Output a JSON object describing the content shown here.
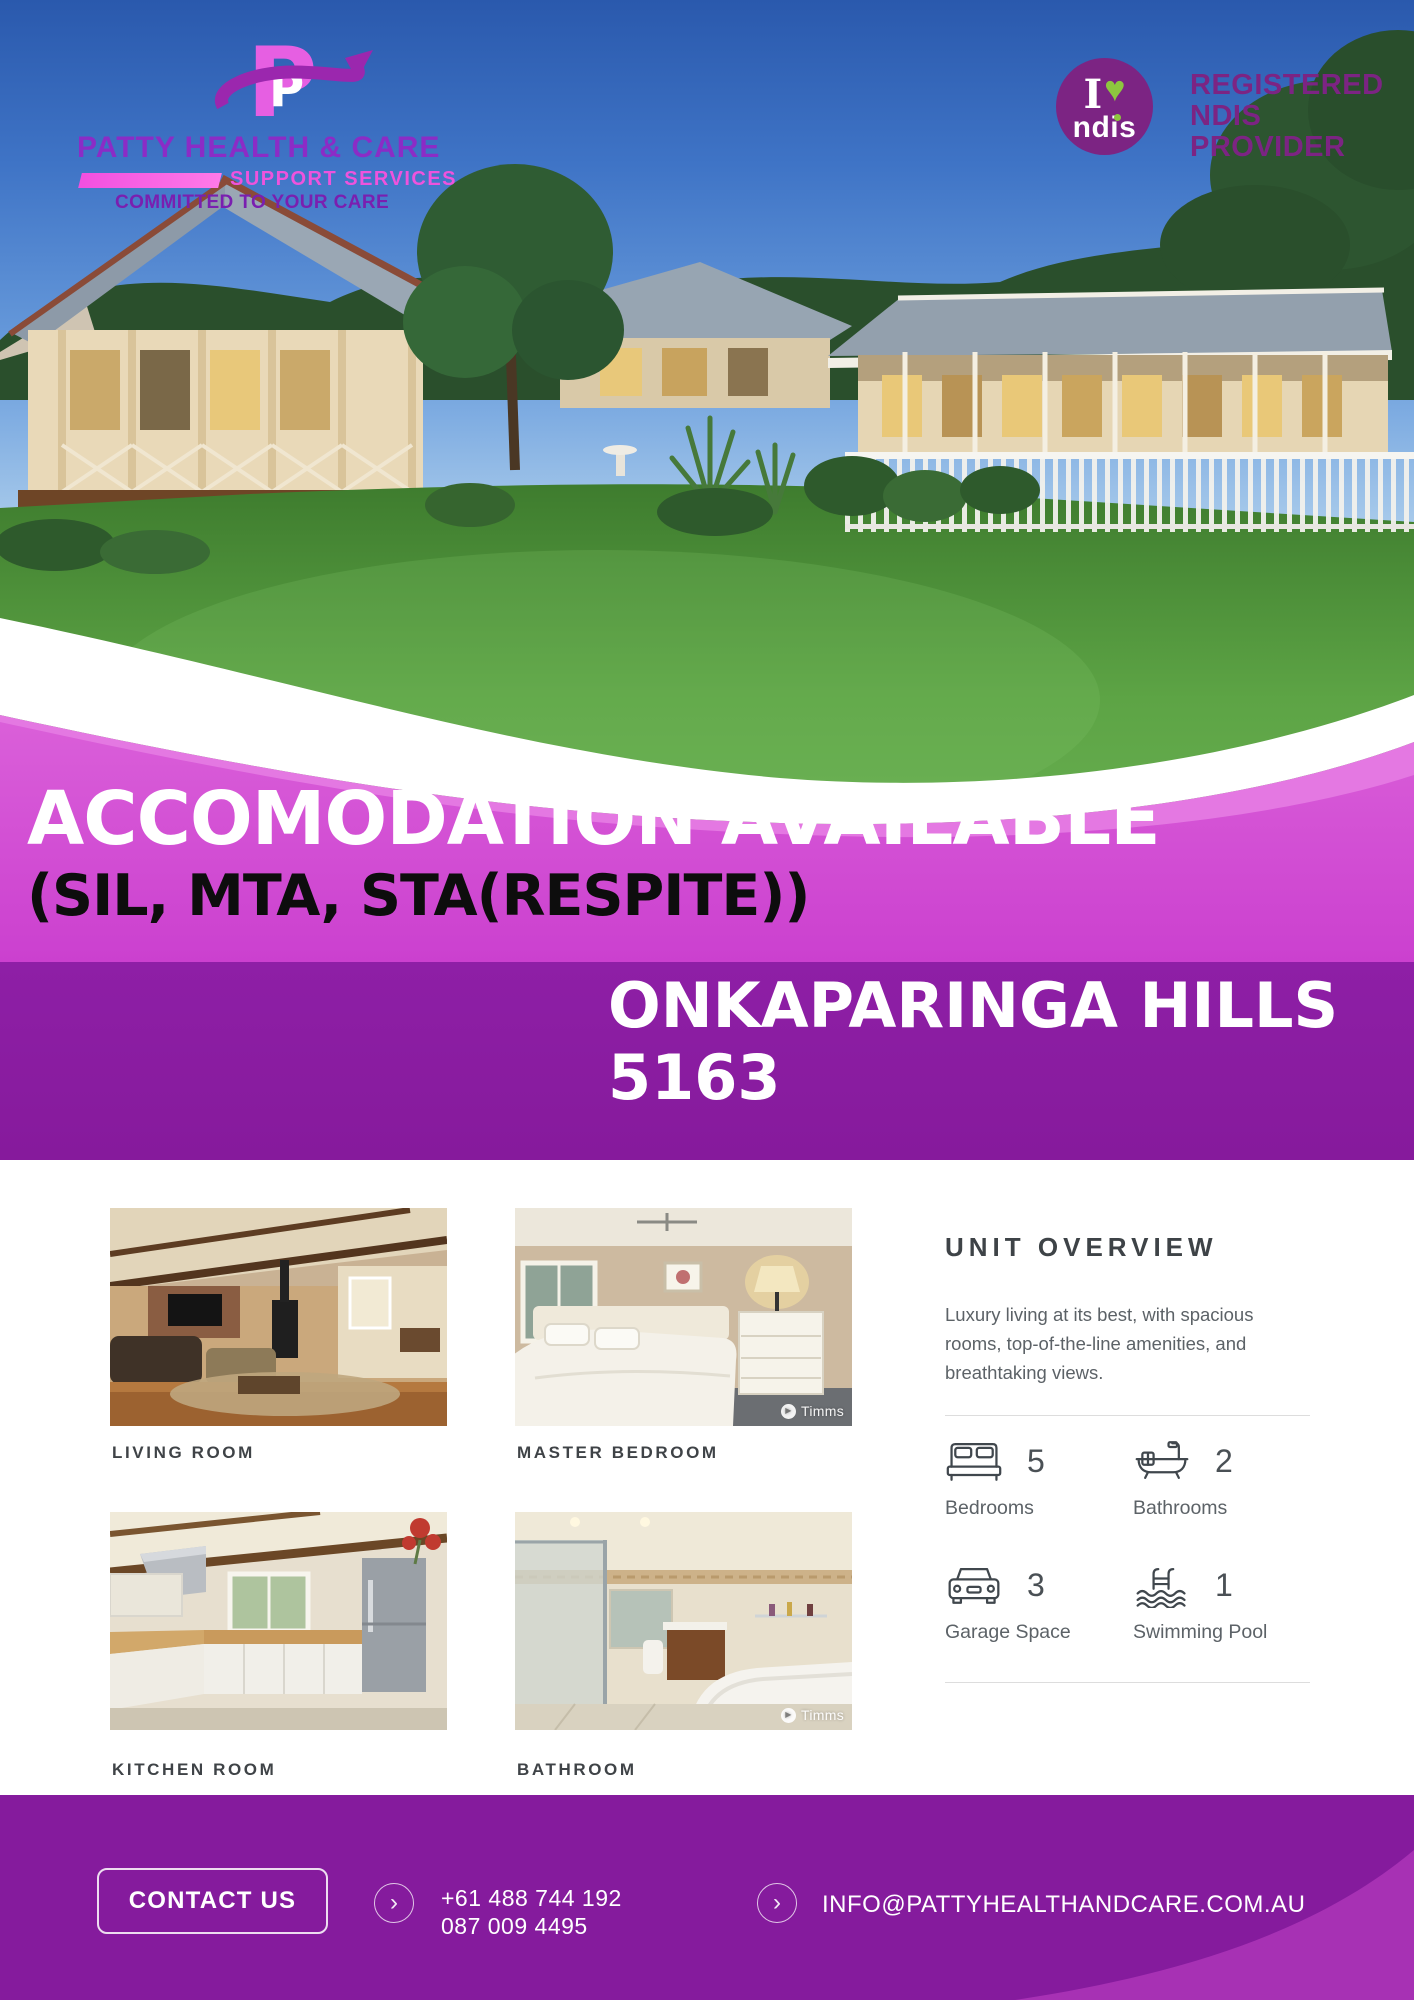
{
  "brand": {
    "name": "PATTY HEALTH & CARE",
    "tagline": "SUPPORT SERVICES",
    "motto": "COMMITTED TO YOUR CARE",
    "logo_letter": "P"
  },
  "ndis": {
    "i": "I",
    "heart": "♥",
    "word": "ndis",
    "line1": "REGISTERED",
    "line2": "NDIS",
    "line3": "PROVIDER"
  },
  "hero": {
    "headline": "ACCOMODATION AVAILABLE",
    "subheadline": "(SIL, MTA, STA(RESPITE))"
  },
  "location": {
    "line1": "ONKAPARINGA HILLS",
    "line2": "5163"
  },
  "gallery": [
    {
      "label": "LIVING ROOM"
    },
    {
      "label": "MASTER BEDROOM",
      "watermark": "Timms"
    },
    {
      "label": "KITCHEN ROOM"
    },
    {
      "label": "BATHROOM",
      "watermark": "Timms"
    }
  ],
  "overview": {
    "title": "UNIT OVERVIEW",
    "description": "Luxury living at its best, with spacious rooms, top-of-the-line amenities, and breathtaking views.",
    "features": [
      {
        "icon": "bed-icon",
        "count": "5",
        "label": "Bedrooms"
      },
      {
        "icon": "bathtub-icon",
        "count": "2",
        "label": "Bathrooms"
      },
      {
        "icon": "car-icon",
        "count": "3",
        "label": "Garage Space"
      },
      {
        "icon": "pool-icon",
        "count": "1",
        "label": "Swimming Pool"
      }
    ]
  },
  "footer": {
    "contact_button": "CONTACT US",
    "phone_line1": "+61 488 744 192",
    "phone_line2": "087 009 4495",
    "email": "INFO@PATTYHEALTHANDCARE.COM.AU"
  },
  "colors": {
    "magenta_banner": "#cf4fd4",
    "purple_banner": "#8a1ba2",
    "footer_purple": "#851b9d",
    "brand_purple": "#8b2cc6",
    "brand_pink": "#ee53dd",
    "motto_purple": "#7a1fb0",
    "ndis_purple": "#7c2483",
    "ndis_green": "#8dc63f",
    "heading_gray": "#3e4347",
    "body_gray": "#5c6267"
  }
}
